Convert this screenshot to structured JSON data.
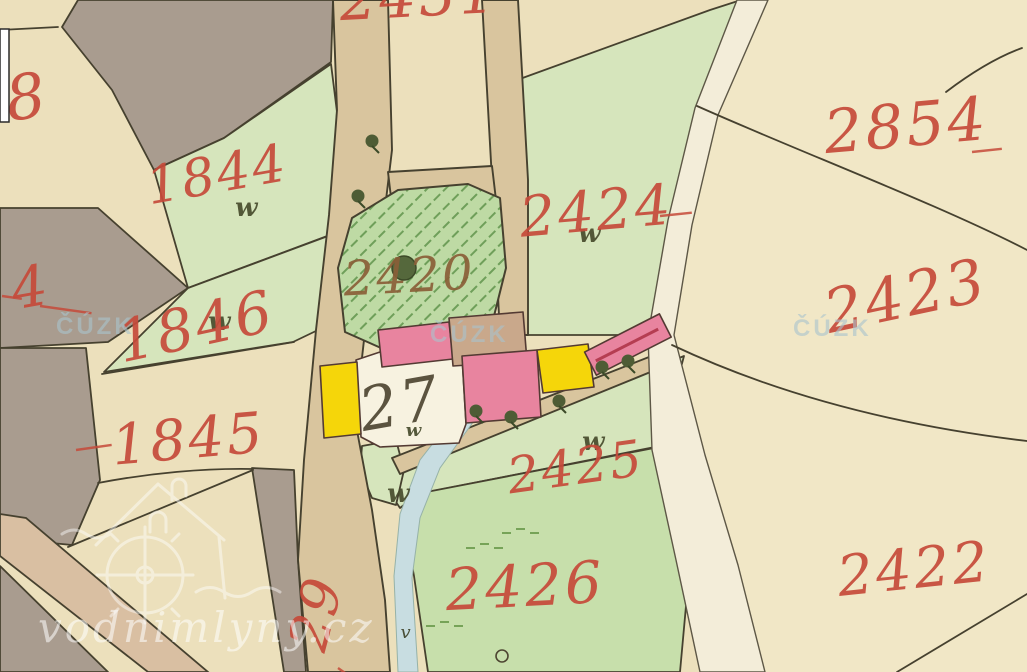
{
  "map": {
    "description_labels": {
      "parcel_labels": [
        {
          "text": "2431",
          "x": 420,
          "y": 16,
          "size": 58,
          "rot": -3
        },
        {
          "text": "8",
          "x": 30,
          "y": 118,
          "size": 62,
          "rot": -8
        },
        {
          "text": "2854",
          "x": 908,
          "y": 146,
          "size": 60,
          "rot": -5
        },
        {
          "text": "1844",
          "x": 220,
          "y": 192,
          "size": 52,
          "rot": -10
        },
        {
          "text": "2424",
          "x": 598,
          "y": 230,
          "size": 56,
          "rot": -5
        },
        {
          "text": "2420",
          "x": 410,
          "y": 292,
          "size": 48,
          "rot": -3,
          "color": "#8a5f38"
        },
        {
          "text": "2423",
          "x": 910,
          "y": 316,
          "size": 60,
          "rot": -12
        },
        {
          "text": "1846",
          "x": 200,
          "y": 346,
          "size": 58,
          "rot": -12
        },
        {
          "text": "4",
          "x": 34,
          "y": 306,
          "size": 56,
          "rot": -10
        },
        {
          "text": "1845",
          "x": 190,
          "y": 458,
          "size": 56,
          "rot": -5
        },
        {
          "text": "2425",
          "x": 578,
          "y": 484,
          "size": 50,
          "rot": -8
        },
        {
          "text": "27",
          "x": 404,
          "y": 424,
          "size": 60,
          "rot": -10,
          "color": "#4e4632"
        },
        {
          "text": "2426",
          "x": 526,
          "y": 606,
          "size": 58,
          "rot": -3
        },
        {
          "text": "2422",
          "x": 916,
          "y": 588,
          "size": 56,
          "rot": -6
        },
        {
          "text": "29",
          "x": 334,
          "y": 618,
          "size": 54,
          "rot": -75
        }
      ],
      "ink_dashes": [
        {
          "x": 2,
          "y": 296,
          "len": 20,
          "rot": 8
        },
        {
          "x": 40,
          "y": 306,
          "len": 52,
          "rot": 8
        },
        {
          "x": 76,
          "y": 450,
          "len": 36,
          "rot": -8
        },
        {
          "x": 972,
          "y": 152,
          "len": 30,
          "rot": -6
        },
        {
          "x": 660,
          "y": 216,
          "len": 32,
          "rot": -6
        },
        {
          "x": 338,
          "y": 668,
          "len": 22,
          "rot": 35
        }
      ]
    },
    "symbols": [
      {
        "type": "meadow",
        "x": 247,
        "y": 216
      },
      {
        "type": "meadow",
        "x": 220,
        "y": 330
      },
      {
        "type": "meadow",
        "x": 590,
        "y": 242
      },
      {
        "type": "meadow",
        "x": 594,
        "y": 450
      },
      {
        "type": "meadow",
        "x": 399,
        "y": 502
      },
      {
        "type": "meadow",
        "x": 414,
        "y": 436,
        "s": 18
      },
      {
        "type": "tree",
        "x": 372,
        "y": 141
      },
      {
        "type": "tree",
        "x": 358,
        "y": 196
      },
      {
        "type": "garden-tree",
        "x": 404,
        "y": 268
      },
      {
        "type": "tree",
        "x": 476,
        "y": 411
      },
      {
        "type": "tree",
        "x": 511,
        "y": 417
      },
      {
        "type": "tree",
        "x": 559,
        "y": 401
      },
      {
        "type": "tree",
        "x": 602,
        "y": 367
      },
      {
        "type": "tree",
        "x": 628,
        "y": 361
      },
      {
        "type": "grass",
        "x": 480,
        "y": 548
      },
      {
        "type": "grass",
        "x": 516,
        "y": 533
      },
      {
        "type": "grass",
        "x": 440,
        "y": 626
      },
      {
        "type": "ring",
        "x": 502,
        "y": 656
      },
      {
        "type": "varrow",
        "x": 406,
        "y": 638
      }
    ],
    "watermarks": {
      "cuzk": {
        "text": "ČÚZK",
        "positions": [
          {
            "x": 56,
            "y": 334
          },
          {
            "x": 430,
            "y": 342
          },
          {
            "x": 793,
            "y": 336
          }
        ]
      },
      "site": {
        "text": "vodnimlyny.cz"
      }
    },
    "ink": {
      "number_red": "#c64a3a",
      "dark_number": "#4e4632",
      "garden_number": "#8a5f38"
    },
    "palette": {
      "paper": "#ece0bc",
      "paper_light": "#f3e9cb",
      "field_gray": "#a99c8f",
      "meadow_green": "#d6e5bc",
      "meadow_green_dark": "#c7dfab",
      "garden_green": "#bedaa4",
      "garden_hatch": "#6f9f5a",
      "road_tan": "#d9c59e",
      "road_pink": "#d9bfa2",
      "stream_blue": "#c8dde1",
      "path_white": "#f3edd9",
      "building_pink": "#e8849f",
      "building_yellow": "#f5d60a",
      "building_tan": "#c9a88b",
      "boundary_line": "#46412f"
    }
  }
}
